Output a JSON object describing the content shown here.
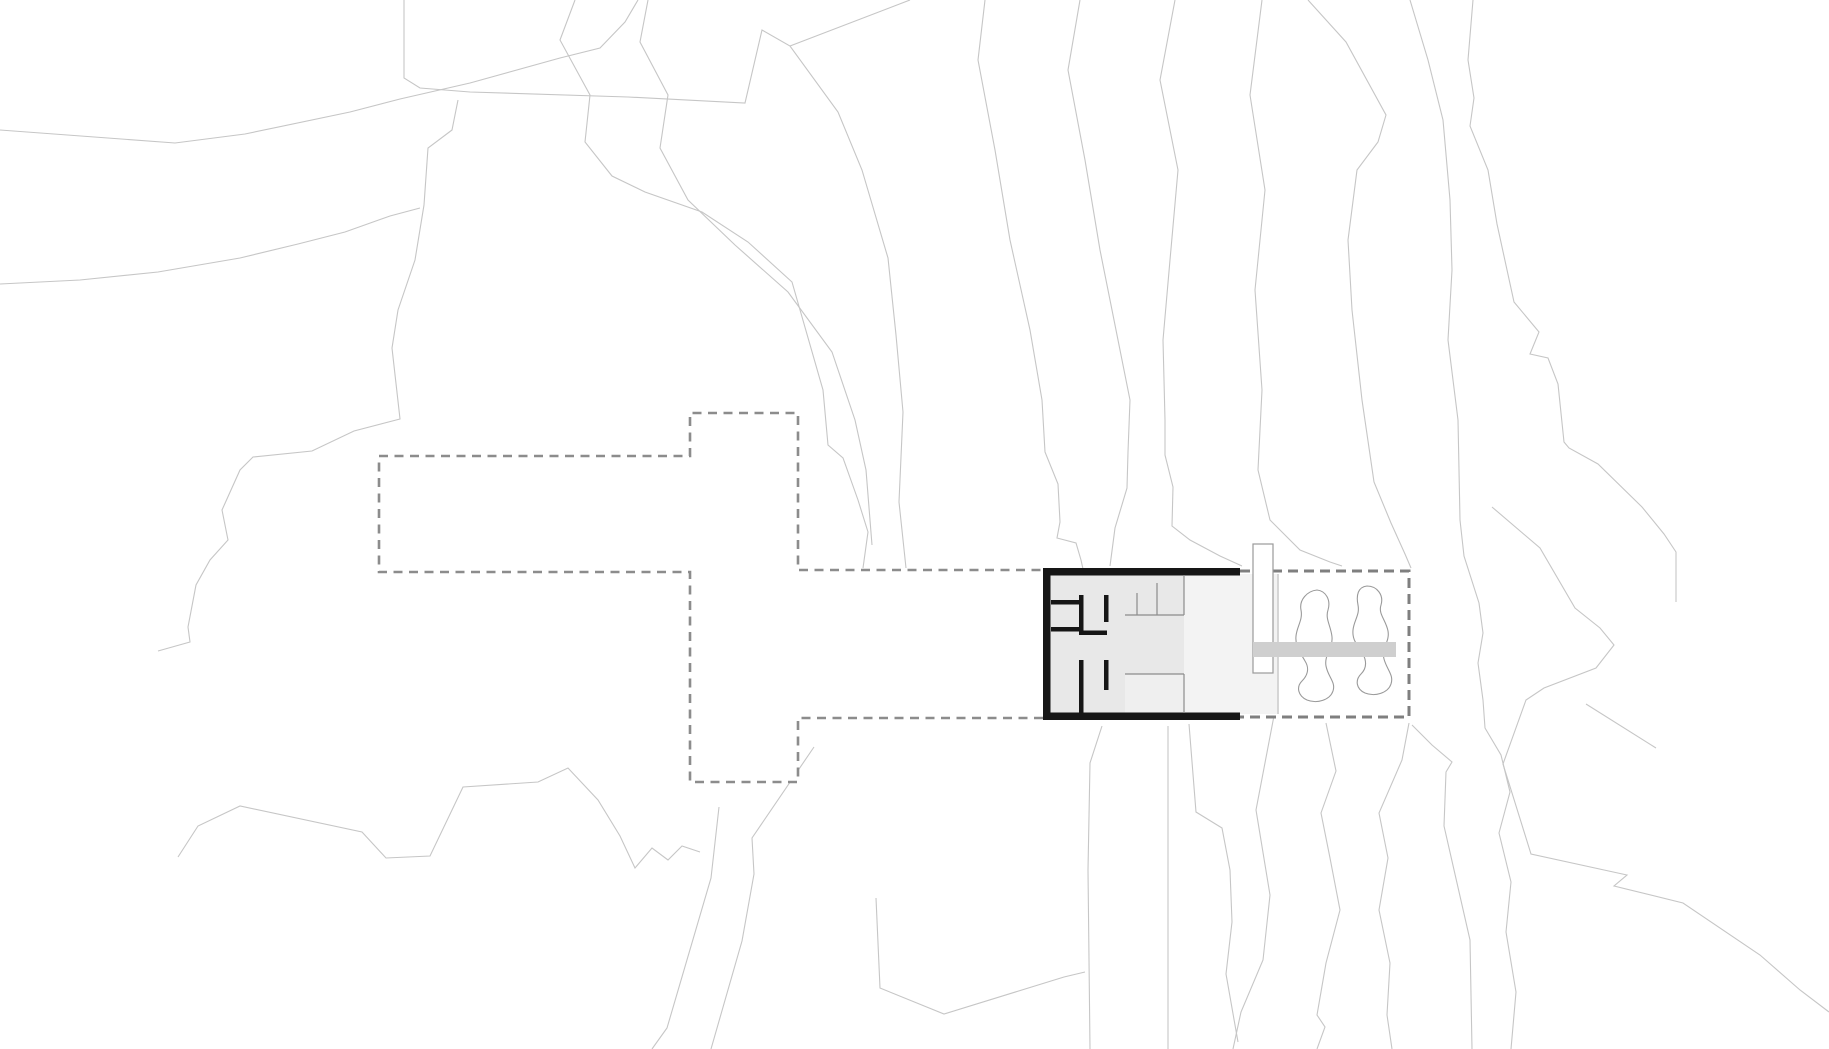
{
  "colors": {
    "background": "#ffffff",
    "contour_line": "#c6c6c6",
    "site_outline_dash": "#8c8c8c",
    "garden_outline_dash": "#7f7f7f",
    "building_wall": "#161616",
    "building_interior": "#e8e8e8",
    "porch_interior": "#f3f3f3",
    "inset_floor": "#efefef",
    "deck_bar": "#cfcfcf",
    "rock_outline": "#9a9a9a",
    "fixture_line": "#8c8c8c"
  },
  "plan": {
    "width": 1829,
    "height": 1049,
    "background": "#ffffff",
    "layers": [
      {
        "name": "contour-line",
        "kind": "polyline",
        "stroke": "#c6c6c6",
        "width": 1.1,
        "items": [
          "0,130 175,143 245,134 350,112 400,99 470,83 560,58 600,48 625,22 638,0",
          "0,284 80,280 158,272 240,258 298,244 345,232 390,216 420,208",
          "458,100 452,130 428,148 424,205 415,260 398,310 392,348 400,419 354,431 312,451 253,457 240,470 222,510 228,540 210,560 196,585 188,627 190,642 158,651",
          "404,0 404,78 420,88 470,92 628,97 745,103 762,30 790,46 838,112 862,170 888,258 896,335 903,412 899,502 906,568",
          "910,0 790,46",
          "575,0 560,40 590,95 585,142 612,176 645,192 702,212 748,242 792,282 823,390 828,445 843,458 858,500 868,532 863,568",
          "648,0 640,42 668,95 660,148 688,200 735,245 788,292 832,352 855,420 866,470 872,545",
          "985,0 978,60 995,150 1010,240 1030,330 1042,400 1045,452 1058,484 1060,522 1057,538 1076,543 1081,560 1083,569",
          "1080,0 1068,70 1085,160 1100,250 1118,340 1130,400 1128,452 1127,488 1115,528 1110,566",
          "1175,0 1160,80 1178,170 1170,260 1163,340 1165,420 1165,455 1173,487 1172,526 1190,540 1220,556 1242,566",
          "1262,0 1250,95 1265,190 1255,290 1262,390 1258,470 1270,520 1300,550 1330,562 1342,566",
          "1308,0 1346,42 1386,115 1378,142 1357,170 1348,240 1352,310 1362,400 1374,482 1391,523 1405,554 1411,568",
          "1410,0 1428,60 1443,120 1450,200 1452,270 1448,340 1458,420 1460,520 1464,556 1479,603 1483,633 1478,663 1483,700 1485,728 1501,755 1510,792 1499,833 1511,882 1506,932 1516,992 1511,1049",
          "1473,0 1468,60 1474,98 1470,126 1488,170 1497,224 1514,302 1539,332 1530,354 1548,358 1558,384 1564,442 1569,448 1598,464 1642,507 1664,534 1676,552 1676,602",
          "1492,507 1540,548 1575,608 1600,628 1614,645 1596,668 1544,688 1526,700 1503,764 1531,854 1627,875 1614,886 1683,903 1760,955 1800,990 1829,1012",
          "1586,704 1656,748",
          "1102,726 1090,763 1088,870 1090,1049",
          "1168,726 1168,1049",
          "1189,724 1196,812 1222,828 1230,870 1232,922 1226,974 1238,1042",
          "1277,700 1256,810 1270,895 1263,960 1241,1012 1233,1049",
          "1326,723 1336,771 1321,813 1330,858 1340,910 1326,963 1317,1015 1325,1027 1317,1049",
          "1409,723 1402,760 1379,813 1388,858 1379,910 1390,963 1387,1015 1392,1049",
          "1412,725 1432,745 1452,762 1446,772 1444,826 1470,940 1472,1049",
          "876,898 880,988 944,1014 1064,977 1085,972",
          "814,747 752,838 754,874 742,941 711,1049",
          "719,807 711,878 667,1028 652,1049",
          "178,857 198,826 240,806 362,832 386,858 430,856 463,787 538,782 568,768 598,800 620,836 635,868 652,848 668,860 682,846 700,852"
        ]
      },
      {
        "name": "site-area-mask",
        "kind": "path",
        "fill": "#ffffff",
        "items": [
          "M379,456 H690 V413 H798 V570 H1409 V718 H798 V782 H690 V572 H379 Z"
        ]
      },
      {
        "name": "site-outline-dashed",
        "kind": "path",
        "stroke": "#8c8c8c",
        "width": 2.6,
        "dash": "9 6.5",
        "items": [
          "M379,456 H690 V413 H798 V570 H1043",
          "M1043,718 H798 V782 H690 V572 H379 V456"
        ]
      },
      {
        "name": "garden-outline-dashed",
        "kind": "path",
        "stroke": "#7f7f7f",
        "width": 3,
        "dash": "10 6",
        "items": [
          "M1240,571 H1409 V717 H1240"
        ]
      },
      {
        "name": "terrace-fill",
        "kind": "rect",
        "fill": "#f3f3f3",
        "items": [
          [
            1240,
            574,
            39,
            140
          ]
        ]
      },
      {
        "name": "terrace-edge-line",
        "kind": "path",
        "stroke": "#bdbdbd",
        "width": 1.1,
        "items": [
          "M1278,574 V714"
        ]
      },
      {
        "name": "building-floor-main",
        "kind": "rect",
        "fill": "#e8e8e8",
        "items": [
          [
            1050,
            575,
            134,
            138
          ]
        ]
      },
      {
        "name": "building-floor-porch",
        "kind": "rect",
        "fill": "#f3f3f3",
        "items": [
          [
            1184,
            575,
            56,
            138
          ]
        ]
      },
      {
        "name": "building-floor-inset",
        "kind": "rect",
        "fill": "#efefef",
        "items": [
          [
            1125,
            674,
            59,
            39
          ]
        ]
      },
      {
        "name": "building-wall",
        "kind": "rect",
        "fill": "#161616",
        "items": [
          [
            1043,
            568,
            197,
            7.5
          ],
          [
            1043,
            712.5,
            197,
            7.5
          ],
          [
            1043,
            568,
            7.5,
            152
          ],
          [
            1051,
            600,
            28,
            4.5
          ],
          [
            1051,
            627,
            28,
            4.5
          ],
          [
            1079,
            595,
            4.5,
            40
          ],
          [
            1079,
            630.5,
            28,
            4.5
          ],
          [
            1104,
            595,
            4.5,
            27
          ],
          [
            1079,
            660,
            4.5,
            53
          ],
          [
            1104,
            660,
            4.5,
            30
          ]
        ]
      },
      {
        "name": "fixture-line",
        "kind": "path",
        "stroke": "#8c8c8c",
        "width": 1.2,
        "items": [
          "M1125,615 H1184",
          "M1137,593 V615",
          "M1157,583 V615",
          "M1184,575 V615",
          "M1125,674 H1184",
          "M1184,674 V713"
        ]
      },
      {
        "name": "rock-outline",
        "kind": "path",
        "stroke": "#9a9a9a",
        "width": 1.1,
        "fill": "#ffffff",
        "items": [
          "M1317,590 C1326,591 1331,600 1328,610 C1325,619 1331,626 1332,637 C1333,648 1324,655 1326,666 C1328,677 1336,682 1333,691 C1330,700 1317,704 1307,700 C1298,696 1296,687 1302,681 C1307,676 1310,669 1305,661 C1300,652 1295,647 1296,636 C1297,626 1303,620 1301,610 C1299,600 1307,591 1317,590 Z",
          "M1367,586 C1377,586 1384,595 1381,605 C1378,614 1386,620 1388,631 C1390,642 1381,648 1384,659 C1387,670 1394,675 1391,684 C1388,693 1375,697 1365,693 C1356,689 1355,680 1361,674 C1366,669 1367,662 1363,654 C1358,645 1352,641 1353,630 C1354,620 1360,615 1358,605 C1356,595 1358,587 1367,586 Z"
        ]
      },
      {
        "name": "chimney-bar",
        "kind": "rect",
        "fill": "#ffffff",
        "stroke": "#9a9a9a",
        "width": 1.2,
        "items": [
          [
            1253,
            544,
            20,
            129
          ]
        ]
      },
      {
        "name": "deck-bar",
        "kind": "rect",
        "fill": "#cfcfcf",
        "items": [
          [
            1253,
            642,
            143,
            15
          ]
        ]
      }
    ]
  }
}
